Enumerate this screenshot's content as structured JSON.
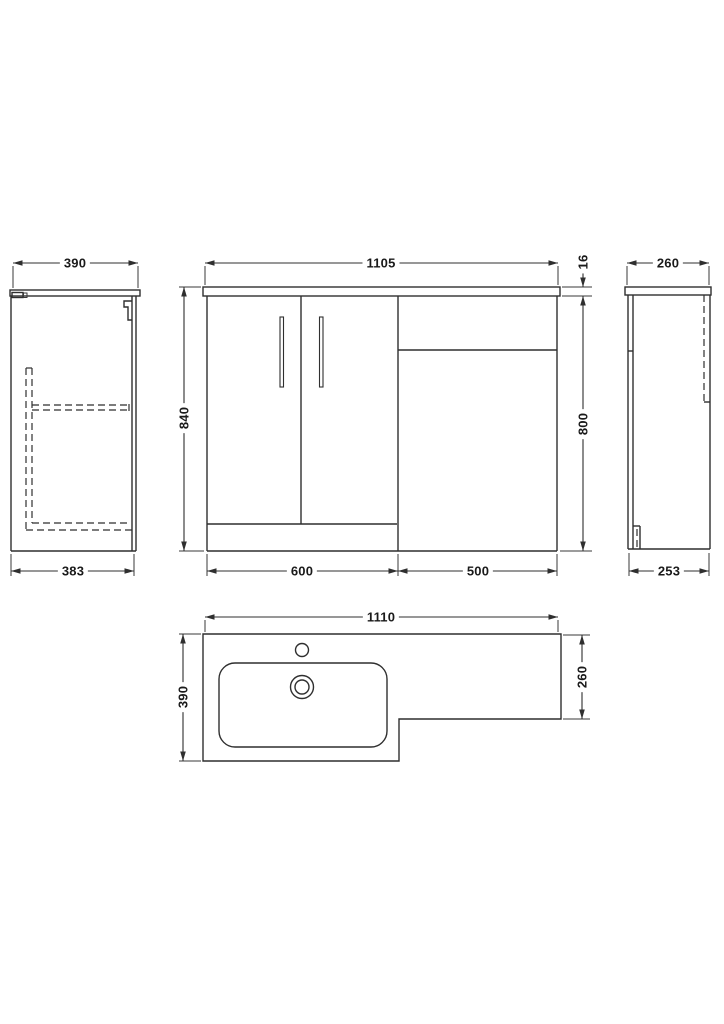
{
  "drawing": {
    "type": "technical-drawing",
    "subject": "L-shaped bathroom vanity and WC combination unit, orthographic views with dimensions",
    "colors": {
      "background": "#ffffff",
      "line": "#2f2f2f",
      "text": "#1a1a1a"
    },
    "views": {
      "left_side": {
        "label_width_top": "390",
        "label_width_bottom": "383"
      },
      "front": {
        "label_width_top": "1105",
        "label_height_left": "840",
        "label_worktop_thickness": "16",
        "label_height_right": "800",
        "label_vanity_width": "600",
        "label_toilet_unit_width": "500"
      },
      "right_side": {
        "label_width_top": "260",
        "label_width_bottom": "253"
      },
      "plan": {
        "label_width_top": "1110",
        "label_depth_left": "390",
        "label_depth_right": "260"
      }
    }
  }
}
